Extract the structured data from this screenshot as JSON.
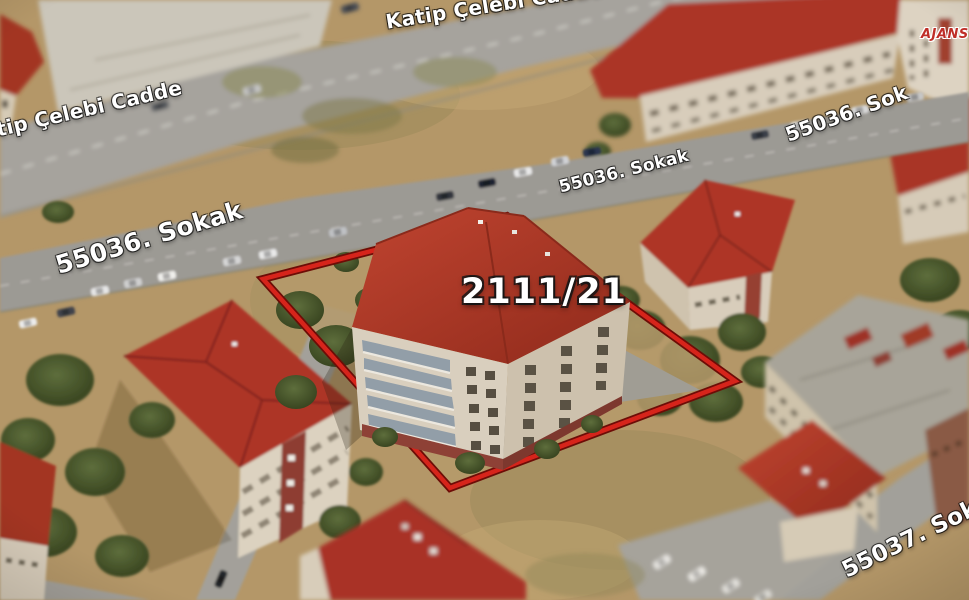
{
  "overlay": {
    "streets": {
      "katip_celebi_top": "Katip Çelebi Cadde",
      "katip_celebi_left": "tip Çelebi Cadde",
      "s55036_left": "55036. Sokak",
      "s55036_center": "55036. Sokak",
      "s55036_right": "55036. Sok",
      "s55037_bottom": "55037. Sokak"
    },
    "parcel_label": "2111/21",
    "watermark": "AJANS",
    "colors": {
      "parcel_outline": "#d6241b",
      "parcel_outline_border": "#6d0d07",
      "street_label_text": "#ffffff",
      "watermark_red": "#bf2e27",
      "roof_red": "#a93326",
      "ground_tan": "#b49768",
      "road_gray": "#9c9a94"
    }
  }
}
